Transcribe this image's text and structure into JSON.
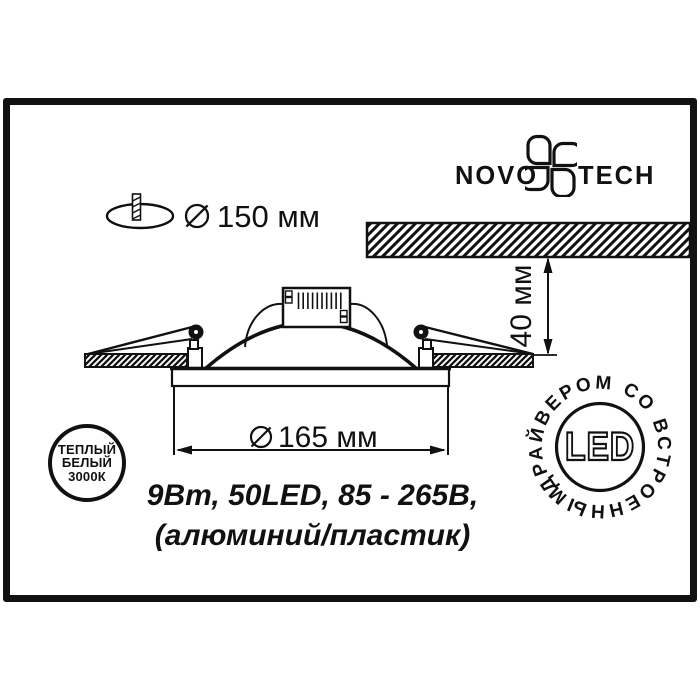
{
  "colors": {
    "ink": "#111111",
    "paper": "#ffffff"
  },
  "logo": {
    "left": "NOVO",
    "right": "TECH"
  },
  "cutout_dim": {
    "value": "150 мм"
  },
  "height_dim": {
    "value": "40 мм"
  },
  "diameter_dim": {
    "value": "165 мм"
  },
  "specs": {
    "line1": "9Вт, 50LED, 85 - 265В,",
    "line2": "(алюминий/пластик)"
  },
  "warm_badge": {
    "line1": "ТЕПЛЫЙ",
    "line2": "БЕЛЫЙ",
    "line3": "3000К"
  },
  "led_badge": {
    "label": "LED",
    "ring_text": "ДРАЙВЕРОМ СО ВСТРОЕННЫМ"
  }
}
